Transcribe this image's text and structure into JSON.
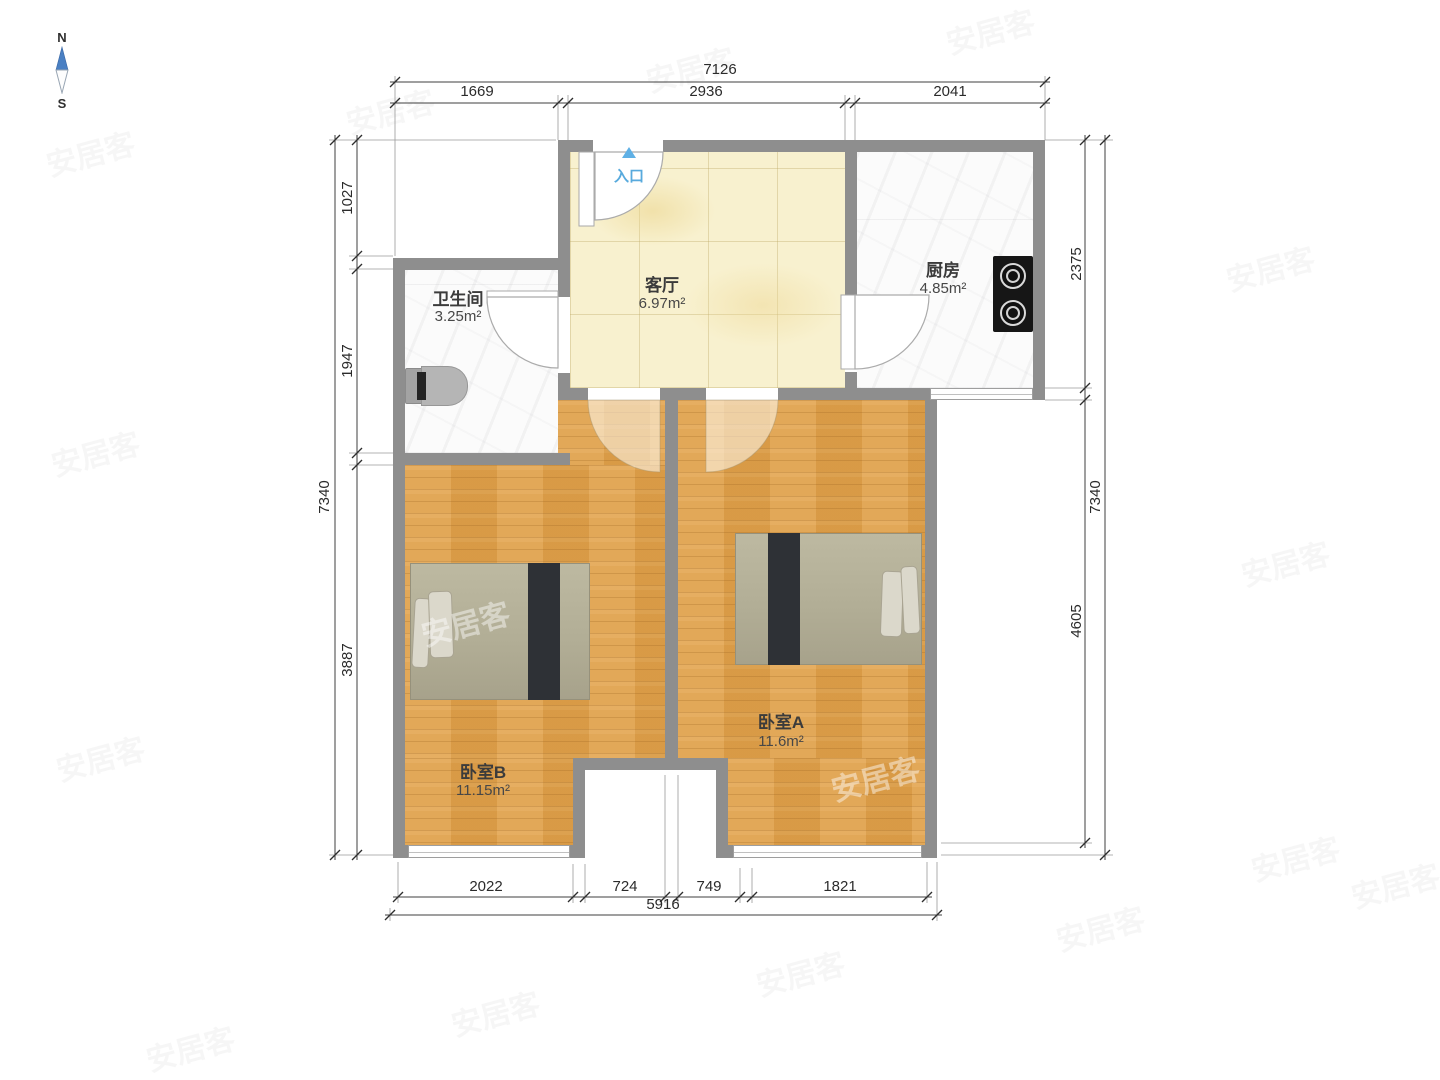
{
  "compass": {
    "north": "N",
    "south": "S"
  },
  "entrance": {
    "label": "入口"
  },
  "rooms": {
    "living": {
      "name": "客厅",
      "area": "6.97m²"
    },
    "kitchen": {
      "name": "厨房",
      "area": "4.85m²"
    },
    "bathroom": {
      "name": "卫生间",
      "area": "3.25m²"
    },
    "bedroom_a": {
      "name": "卧室A",
      "area": "11.6m²"
    },
    "bedroom_b": {
      "name": "卧室B",
      "area": "11.15m²"
    }
  },
  "dimensions": {
    "top": {
      "total": "7126",
      "segments": [
        "1669",
        "2936",
        "2041"
      ]
    },
    "bottom": {
      "total": "5916",
      "segments": [
        "2022",
        "724",
        "749",
        "1821"
      ]
    },
    "left": {
      "total": "7340",
      "segments": [
        "1027",
        "1947",
        "3887"
      ]
    },
    "right": {
      "total": "7340",
      "segments": [
        "2375",
        "4605"
      ]
    }
  },
  "watermark": {
    "text": "安居客"
  },
  "colors": {
    "wall": "#8e8e8e",
    "wood_floor": "#e0a14b",
    "tile_floor": "#f8f1cf",
    "marble_floor": "#fbfbfb",
    "entrance_blue": "#5fb0e5",
    "bed_dark_strip": "#2e3136"
  }
}
